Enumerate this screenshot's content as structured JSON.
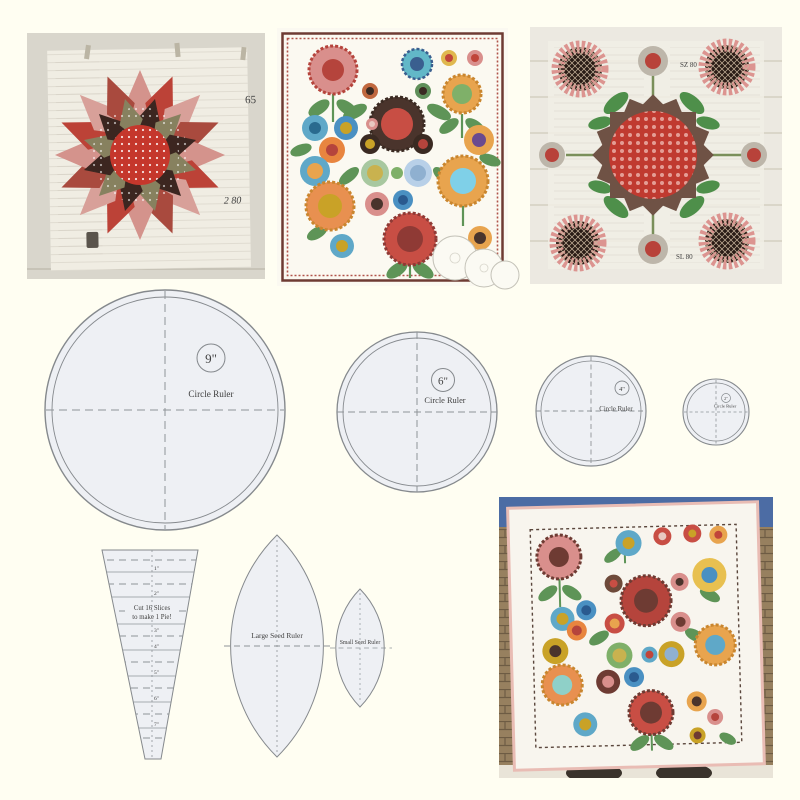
{
  "colors": {
    "page_background": "#FFFEF2",
    "ruler_fill": "#EEF0F4",
    "ruler_stroke": "#85898D",
    "accent_red": "#C0453A",
    "quilt_border_brown": "#6E3B33"
  },
  "templates": {
    "circle_rulers": [
      {
        "size": "9\"",
        "label": "Circle Ruler"
      },
      {
        "size": "6\"",
        "label": "Circle Ruler"
      },
      {
        "size": "4\"",
        "label": "Circle Ruler"
      },
      {
        "size": "2\"",
        "label": "Circle Ruler"
      }
    ],
    "wedge": {
      "line1": "Cut 16 Slices",
      "line2": "to make 1 Pie!",
      "ticks": [
        "1\"",
        "2\"",
        "3\"",
        "4\"",
        "5\"",
        "6\"",
        "7\""
      ]
    },
    "large_seed": {
      "label": "Large Seed Ruler"
    },
    "small_seed": {
      "label": "Small Seed Ruler"
    }
  },
  "photos": {
    "dresden_block": {
      "paper_marks": [
        "65",
        "2 80"
      ]
    },
    "medallion_quilt": {
      "paper_marks": [
        "SZ 80",
        "SL 80"
      ]
    }
  }
}
